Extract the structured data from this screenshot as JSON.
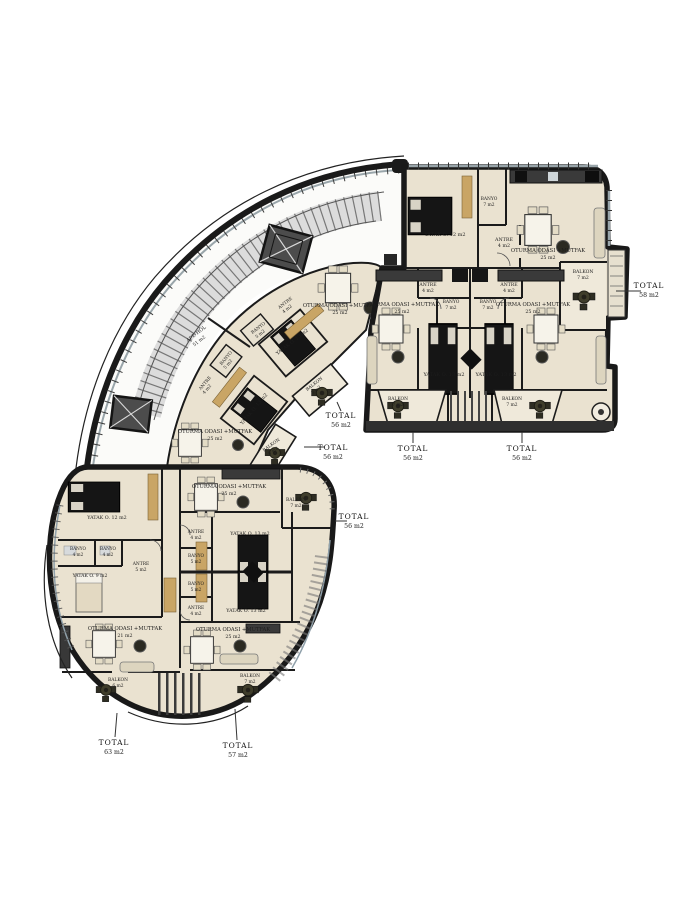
{
  "colors": {
    "wall": "#1b1b1b",
    "floor": "#eae2d0",
    "balcony_floor": "#efe9da",
    "wood": "#c9a565",
    "stairs": "#dcdcdc",
    "glass": "#99a5aa",
    "dark_furniture": "#151515",
    "deck": "#2f2f2f",
    "round_table": "#3f3d2b"
  },
  "labels": [
    {
      "n": "tr-yatak-label",
      "t": "YATAK O. 12 m2",
      "x": 445,
      "y": 236,
      "s": 5
    },
    {
      "n": "tr-banyo-label",
      "t": "BANYO",
      "x": 489,
      "y": 200,
      "s": 4.4
    },
    {
      "n": "tr-banyo-area",
      "t": "7 m2",
      "x": 489,
      "y": 206,
      "s": 4.4
    },
    {
      "n": "tr-antre-label",
      "t": "ANTRE",
      "x": 504,
      "y": 241,
      "s": 4.8
    },
    {
      "n": "tr-antre-area",
      "t": "4 m2",
      "x": 504,
      "y": 247,
      "s": 4.8
    },
    {
      "n": "tr-oturma-label",
      "t": "OTURMA ODASI +MUTFAK",
      "x": 548,
      "y": 252,
      "s": 5.2
    },
    {
      "n": "tr-oturma-area",
      "t": "25 m2",
      "x": 548,
      "y": 259,
      "s": 4.8
    },
    {
      "n": "tr-balkon-label",
      "t": "BALKON",
      "x": 583,
      "y": 273,
      "s": 4.6
    },
    {
      "n": "tr-balkon-area",
      "t": "7 m2",
      "x": 583,
      "y": 279,
      "s": 4.6
    },
    {
      "n": "tr-total-label",
      "t": "TOTAL",
      "x": 649,
      "y": 288,
      "s": 7.5,
      "b": 1
    },
    {
      "n": "tr-total-area",
      "t": "58 m2",
      "x": 649,
      "y": 297,
      "s": 6.2
    },
    {
      "n": "mra-antre-label",
      "t": "ANTRE",
      "x": 428,
      "y": 286,
      "s": 4.6
    },
    {
      "n": "mra-antre-area",
      "t": "4 m2",
      "x": 428,
      "y": 292,
      "s": 4.6
    },
    {
      "n": "mra-banyo-label",
      "t": "BANYO",
      "x": 451,
      "y": 303,
      "s": 4.4
    },
    {
      "n": "mra-banyo-area",
      "t": "7 m2",
      "x": 451,
      "y": 309,
      "s": 4.4
    },
    {
      "n": "mra-oturma-label",
      "t": "OTURMA ODASI +MUTFAK",
      "x": 402,
      "y": 306,
      "s": 5.2
    },
    {
      "n": "mra-oturma-area",
      "t": "25 m2",
      "x": 402,
      "y": 313,
      "s": 4.8
    },
    {
      "n": "mra-yatak-label",
      "t": "YATAK O. 13 m2",
      "x": 444,
      "y": 376,
      "s": 5
    },
    {
      "n": "mra-balkon-label",
      "t": "BALKON",
      "x": 398,
      "y": 400,
      "s": 4.4
    },
    {
      "n": "mra-balkon-area",
      "t": "7 m2",
      "x": 398,
      "y": 406,
      "s": 4.4
    },
    {
      "n": "mra-total-label",
      "t": "TOTAL",
      "x": 413,
      "y": 451,
      "s": 7.5,
      "b": 1
    },
    {
      "n": "mra-total-area",
      "t": "56 m2",
      "x": 413,
      "y": 460,
      "s": 6.2
    },
    {
      "n": "mrb-antre-label",
      "t": "ANTRE",
      "x": 509,
      "y": 286,
      "s": 4.6
    },
    {
      "n": "mrb-antre-area",
      "t": "4 m2",
      "x": 509,
      "y": 292,
      "s": 4.6
    },
    {
      "n": "mrb-banyo-label",
      "t": "BANYO",
      "x": 488,
      "y": 303,
      "s": 4.4
    },
    {
      "n": "mrb-banyo-area",
      "t": "7 m2",
      "x": 488,
      "y": 309,
      "s": 4.4
    },
    {
      "n": "mrb-oturma-label",
      "t": "OTURMA ODASI +MUTFAK",
      "x": 533,
      "y": 306,
      "s": 5.2
    },
    {
      "n": "mrb-oturma-area",
      "t": "25 m2",
      "x": 533,
      "y": 313,
      "s": 4.8
    },
    {
      "n": "mrb-yatak-label",
      "t": "YATAK O. 13 m2",
      "x": 496,
      "y": 376,
      "s": 5
    },
    {
      "n": "mrb-balkon-label",
      "t": "BALKON",
      "x": 512,
      "y": 400,
      "s": 4.4
    },
    {
      "n": "mrb-balkon-area",
      "t": "7 m2",
      "x": 512,
      "y": 406,
      "s": 4.4
    },
    {
      "n": "mrb-total-label",
      "t": "TOTAL",
      "x": 522,
      "y": 451,
      "s": 7.5,
      "b": 1
    },
    {
      "n": "mrb-total-area",
      "t": "56 m2",
      "x": 522,
      "y": 460,
      "s": 6.2
    },
    {
      "n": "c1-antre-label",
      "t": "ANTRE",
      "x": 286,
      "y": 304,
      "r": -38,
      "s": 4.4
    },
    {
      "n": "c1-antre-area",
      "t": "4 m2",
      "x": 288,
      "y": 310,
      "r": -38,
      "s": 4.4
    },
    {
      "n": "c1-banyo-label",
      "t": "BANYO",
      "x": 259,
      "y": 329,
      "r": -38,
      "s": 4.4
    },
    {
      "n": "c1-banyo-area",
      "t": "5 m2",
      "x": 261,
      "y": 335,
      "r": -38,
      "s": 4.4
    },
    {
      "n": "c1-yatak-label",
      "t": "YATAK O. 13 m2",
      "x": 293,
      "y": 343,
      "r": -38,
      "s": 4.8
    },
    {
      "n": "c1-oturma-label",
      "t": "OTURMA ODASI +MUTFAK",
      "x": 340,
      "y": 307,
      "s": 5.2
    },
    {
      "n": "c1-oturma-area",
      "t": "25 m2",
      "x": 340,
      "y": 314,
      "s": 4.8
    },
    {
      "n": "c1-balkon-label",
      "t": "BALKON",
      "x": 315,
      "y": 385,
      "r": -38,
      "s": 4.4
    },
    {
      "n": "c1-balkon-area",
      "t": "5 m2",
      "x": 317,
      "y": 391,
      "r": -38,
      "s": 4.4
    },
    {
      "n": "c1-total-label",
      "t": "TOTAL",
      "x": 341,
      "y": 418,
      "s": 7.5,
      "b": 1
    },
    {
      "n": "c1-total-area",
      "t": "56 m2",
      "x": 341,
      "y": 427,
      "s": 6.2
    },
    {
      "n": "c2-banyo-label",
      "t": "BANYO",
      "x": 227,
      "y": 359,
      "r": -50,
      "s": 4.4
    },
    {
      "n": "c2-banyo-area",
      "t": "5 m2",
      "x": 229,
      "y": 365,
      "r": -50,
      "s": 4.4
    },
    {
      "n": "c2-antre-label",
      "t": "ANTRE",
      "x": 206,
      "y": 384,
      "r": -50,
      "s": 4.4
    },
    {
      "n": "c2-antre-area",
      "t": "4 m2",
      "x": 208,
      "y": 390,
      "r": -50,
      "s": 4.4
    },
    {
      "n": "c2-yatak-label",
      "t": "YATAK O. 13 m2",
      "x": 255,
      "y": 410,
      "r": -50,
      "s": 4.8
    },
    {
      "n": "c2-oturma-label",
      "t": "OTURMA ODASI +MUTFAK",
      "x": 215,
      "y": 433,
      "s": 5.2
    },
    {
      "n": "c2-oturma-area",
      "t": "25 m2",
      "x": 215,
      "y": 440,
      "s": 4.8
    },
    {
      "n": "c2-balkon-label",
      "t": "BALKON",
      "x": 272,
      "y": 446,
      "r": -35,
      "s": 4.4
    },
    {
      "n": "c2-balkon-area",
      "t": "5 m2",
      "x": 274,
      "y": 452,
      "r": -35,
      "s": 4.4
    },
    {
      "n": "c2-total-label",
      "t": "TOTAL",
      "x": 333,
      "y": 450,
      "s": 7.5,
      "b": 1
    },
    {
      "n": "c2-total-area",
      "t": "56 m2",
      "x": 333,
      "y": 459,
      "s": 6.2
    },
    {
      "n": "apt-hol-label",
      "t": "APT. HOL",
      "x": 197,
      "y": 335,
      "r": -38,
      "s": 4.8
    },
    {
      "n": "apt-hol-area",
      "t": "51 m2",
      "x": 200,
      "y": 342,
      "r": -38,
      "s": 4.6
    },
    {
      "n": "dl-yatak12-label",
      "t": "YATAK O. 12 m2",
      "x": 107,
      "y": 519,
      "s": 4.8
    },
    {
      "n": "dl-banyo1-label",
      "t": "BANYO",
      "x": 78,
      "y": 550,
      "s": 4.2
    },
    {
      "n": "dl-banyo1-area",
      "t": "4 m2",
      "x": 78,
      "y": 556,
      "s": 4.2
    },
    {
      "n": "dl-banyo2-label",
      "t": "BANYO",
      "x": 108,
      "y": 550,
      "s": 4.2
    },
    {
      "n": "dl-banyo2-area",
      "t": "4 m2",
      "x": 108,
      "y": 556,
      "s": 4.2
    },
    {
      "n": "dl-antre-label",
      "t": "ANTRE",
      "x": 141,
      "y": 565,
      "s": 4.4
    },
    {
      "n": "dl-antre-area",
      "t": "5 m2",
      "x": 141,
      "y": 571,
      "s": 4.4
    },
    {
      "n": "dl-yatak9-label",
      "t": "YATAK O. 9 m2",
      "x": 90,
      "y": 577,
      "s": 4.6
    },
    {
      "n": "dl-oturma-label",
      "t": "OTURMA ODASI +MUTFAK",
      "x": 125,
      "y": 630,
      "s": 5.2
    },
    {
      "n": "dl-oturma-area",
      "t": "21 m2",
      "x": 125,
      "y": 637,
      "s": 4.8
    },
    {
      "n": "dl-balkon-label",
      "t": "BALKON",
      "x": 118,
      "y": 681,
      "s": 4.4
    },
    {
      "n": "dl-balkon-area",
      "t": "6 m2",
      "x": 118,
      "y": 687,
      "s": 4.4
    },
    {
      "n": "dl-total-label",
      "t": "TOTAL",
      "x": 114,
      "y": 745,
      "s": 7.5,
      "b": 1
    },
    {
      "n": "dl-total-area",
      "t": "63 m2",
      "x": 114,
      "y": 754,
      "s": 6.2
    },
    {
      "n": "d2a-oturma-label",
      "t": "OTURMA ODASI +MUTFAK",
      "x": 229,
      "y": 488,
      "s": 5.2
    },
    {
      "n": "d2a-oturma-area",
      "t": "25 m2",
      "x": 229,
      "y": 495,
      "s": 4.8
    },
    {
      "n": "d2a-antre-label",
      "t": "ANTRE",
      "x": 196,
      "y": 533,
      "s": 4.4
    },
    {
      "n": "d2a-antre-area",
      "t": "4 m2",
      "x": 196,
      "y": 539,
      "s": 4.4
    },
    {
      "n": "d2a-banyo-label",
      "t": "BANYO",
      "x": 196,
      "y": 557,
      "s": 4.2
    },
    {
      "n": "d2a-banyo-area",
      "t": "5 m2",
      "x": 196,
      "y": 563,
      "s": 4.2
    },
    {
      "n": "d2a-yatak-label",
      "t": "YATAK O. 13 m2",
      "x": 250,
      "y": 535,
      "s": 4.8
    },
    {
      "n": "d2a-balkon-label",
      "t": "BALKON",
      "x": 296,
      "y": 501,
      "s": 4.4
    },
    {
      "n": "d2a-balkon-area",
      "t": "7 m2",
      "x": 296,
      "y": 507,
      "s": 4.4
    },
    {
      "n": "d2a-total-label",
      "t": "TOTAL",
      "x": 354,
      "y": 519,
      "s": 7.5,
      "b": 1
    },
    {
      "n": "d2a-total-area",
      "t": "56 m2",
      "x": 354,
      "y": 528,
      "s": 6.2
    },
    {
      "n": "d2b-banyo-label",
      "t": "BANYO",
      "x": 196,
      "y": 585,
      "s": 4.2
    },
    {
      "n": "d2b-banyo-area",
      "t": "5 m2",
      "x": 196,
      "y": 591,
      "s": 4.2
    },
    {
      "n": "d2b-antre-label",
      "t": "ANTRE",
      "x": 196,
      "y": 609,
      "s": 4.4
    },
    {
      "n": "d2b-antre-area",
      "t": "4 m2",
      "x": 196,
      "y": 615,
      "s": 4.4
    },
    {
      "n": "d2b-yatak-label",
      "t": "YATAK O. 13 m2",
      "x": 246,
      "y": 612,
      "s": 4.8
    },
    {
      "n": "d2b-oturma-label",
      "t": "OTURMA ODASI +MUTFAK",
      "x": 233,
      "y": 631,
      "s": 5.2
    },
    {
      "n": "d2b-oturma-area",
      "t": "25 m2",
      "x": 233,
      "y": 638,
      "s": 4.8
    },
    {
      "n": "d2b-balkon-label",
      "t": "BALKON",
      "x": 250,
      "y": 677,
      "s": 4.4
    },
    {
      "n": "d2b-balkon-area",
      "t": "7 m2",
      "x": 250,
      "y": 683,
      "s": 4.4
    },
    {
      "n": "d2b-total-label",
      "t": "TOTAL",
      "x": 238,
      "y": 748,
      "s": 7.5,
      "b": 1
    },
    {
      "n": "d2b-total-area",
      "t": "57 m2",
      "x": 238,
      "y": 757,
      "s": 6.2
    }
  ]
}
